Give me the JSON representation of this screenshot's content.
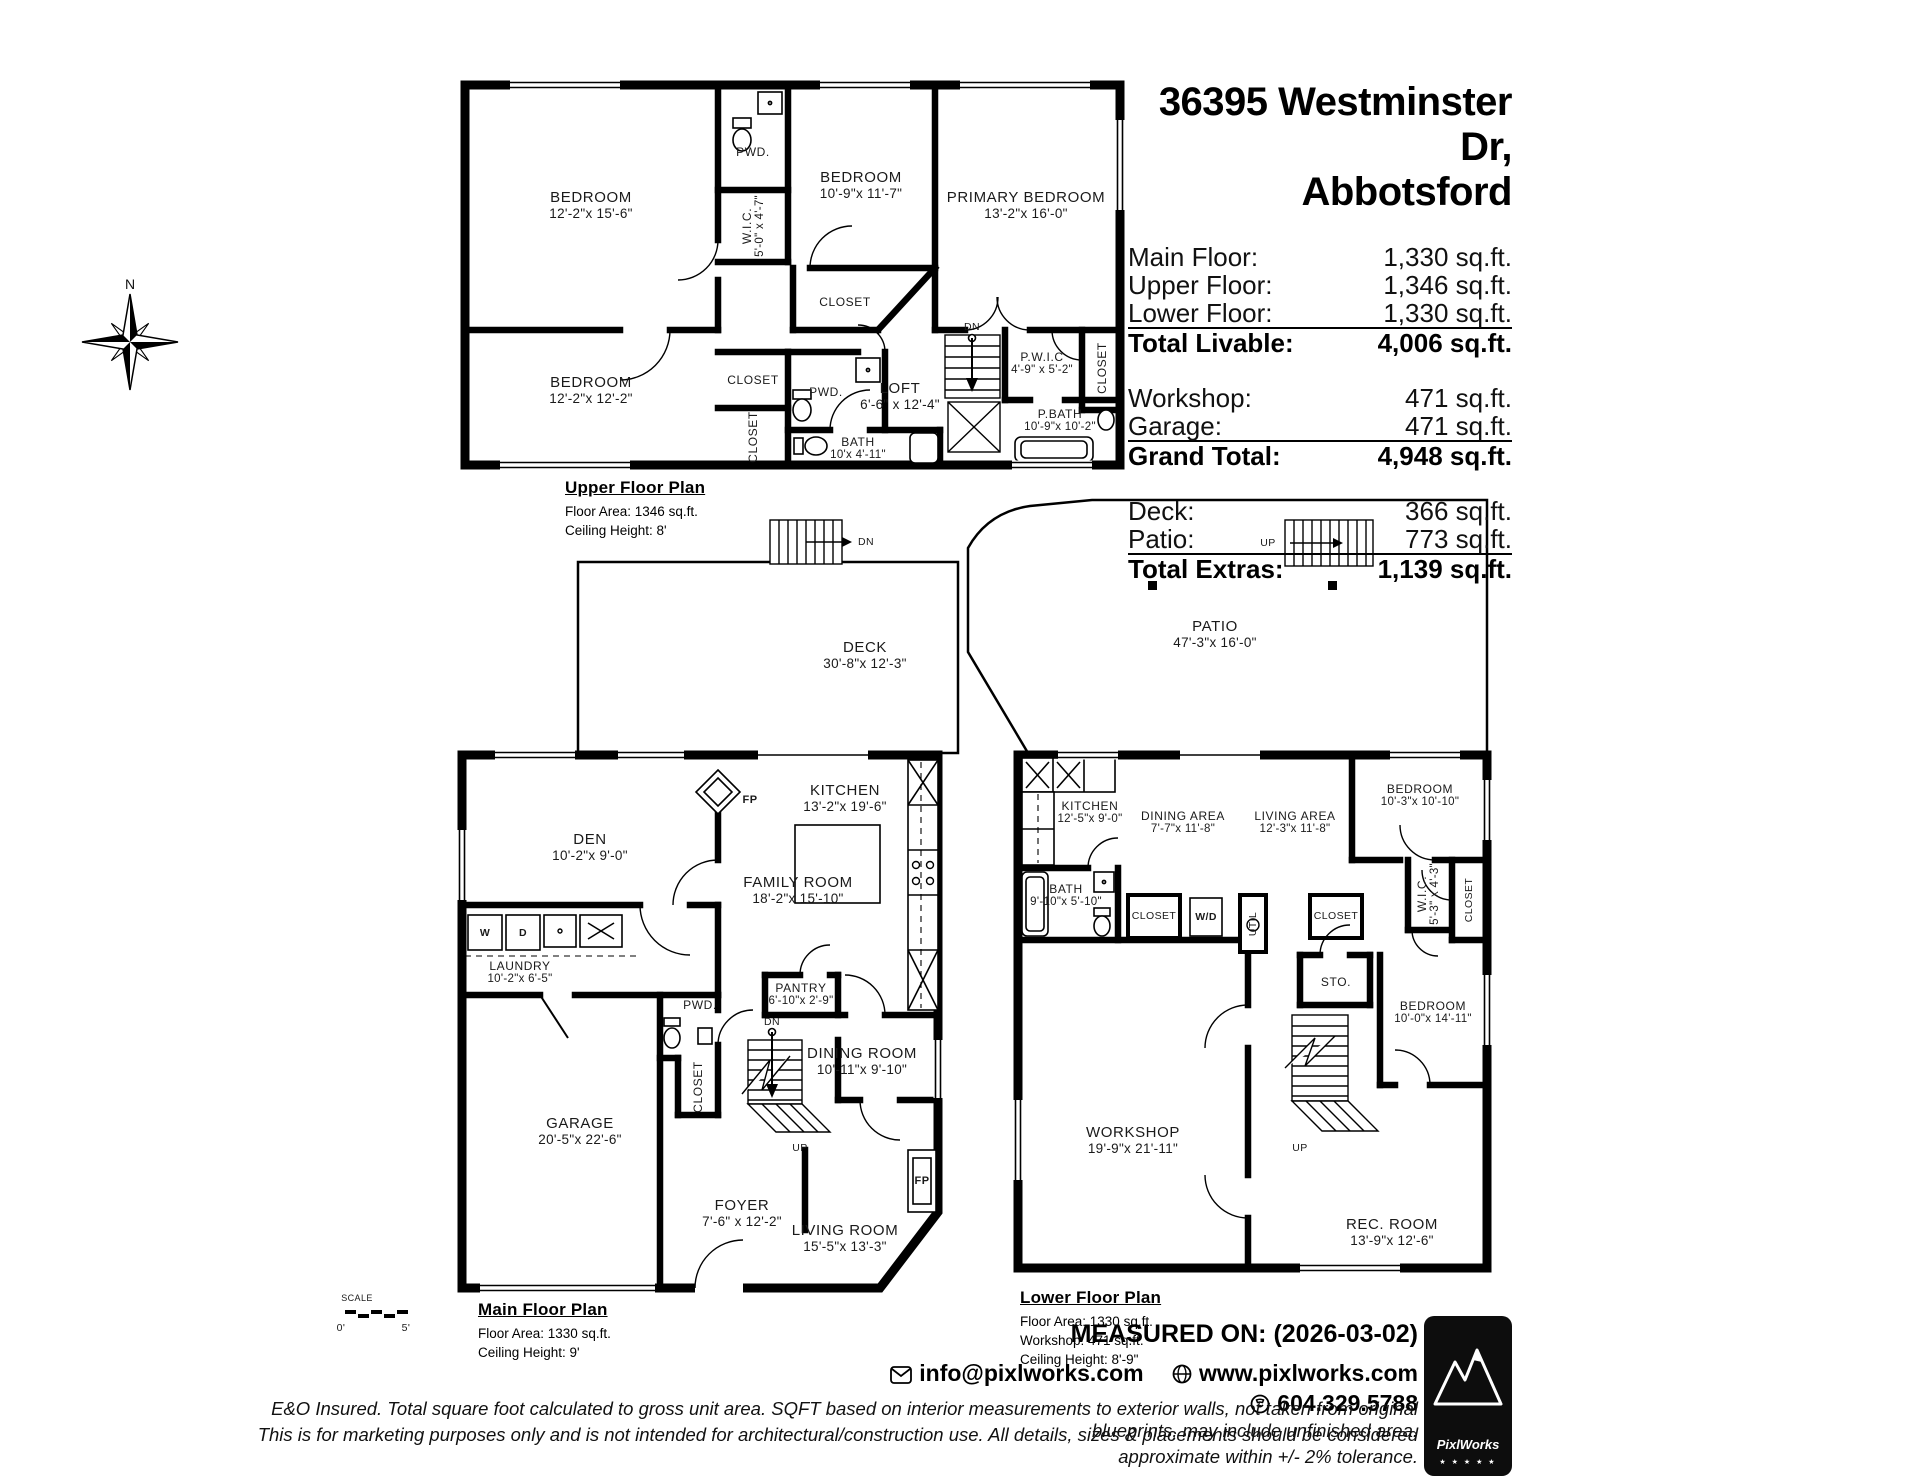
{
  "header": {
    "title1": "36395 Westminster Dr,",
    "title2": "Abbotsford",
    "livable": {
      "rows": [
        {
          "label": "Main Floor:",
          "value": "1,330 sq.ft."
        },
        {
          "label": "Upper Floor:",
          "value": "1,346 sq.ft."
        },
        {
          "label": "Lower Floor:",
          "value": "1,330 sq.ft."
        }
      ],
      "total_label": "Total Livable:",
      "total_value": "4,006 sq.ft."
    },
    "garage_group": {
      "rows": [
        {
          "label": "Workshop:",
          "value": "471 sq.ft."
        },
        {
          "label": "Garage:",
          "value": "471 sq.ft."
        }
      ],
      "total_label": "Grand Total:",
      "total_value": "4,948 sq.ft."
    },
    "extras": {
      "rows": [
        {
          "label": "Deck:",
          "value": "366 sq.ft."
        },
        {
          "label": "Patio:",
          "value": "773 sq.ft."
        }
      ],
      "total_label": "Total Extras:",
      "total_value": "1,139 sq.ft."
    }
  },
  "compass": {
    "north": "N"
  },
  "scale_bar": {
    "label": "SCALE",
    "start": "0'",
    "end": "5'"
  },
  "upper": {
    "caption": {
      "title": "Upper Floor Plan",
      "line1": "Floor Area: 1346 sq.ft.",
      "line2": "Ceiling Height: 8'"
    },
    "rooms": {
      "bedroom1": {
        "name": "BEDROOM",
        "dims": "12'-2\"x 15'-6\""
      },
      "pwd1": {
        "name": "PWD."
      },
      "wic": {
        "name": "W.I.C.",
        "dims": "5'-0\" x 4'-7\""
      },
      "bedroom2": {
        "name": "BEDROOM",
        "dims": "10'-9\"x 11'-7\""
      },
      "closet_b2": {
        "name": "CLOSET"
      },
      "primary": {
        "name": "PRIMARY BEDROOM",
        "dims": "13'-2\"x 16'-0\""
      },
      "bedroom3": {
        "name": "BEDROOM",
        "dims": "12'-2\"x 12'-2\""
      },
      "closet_a": {
        "name": "CLOSET"
      },
      "closet_b": {
        "name": "CLOSET"
      },
      "pwd2": {
        "name": "PWD."
      },
      "loft": {
        "name": "LOFT",
        "dims": "6'-6\" x 12'-4\""
      },
      "dn": {
        "name": "DN"
      },
      "pwic": {
        "name": "P.W.I.C",
        "dims": "4'-9\" x 5'-2\""
      },
      "closet_r": {
        "name": "CLOSET"
      },
      "bath": {
        "name": "BATH",
        "dims": "10'x 4'-11\""
      },
      "pbath": {
        "name": "P.BATH",
        "dims": "10'-9\"x 10'-2\""
      }
    }
  },
  "main": {
    "caption": {
      "title": "Main Floor Plan",
      "line1": "Floor Area: 1330 sq.ft.",
      "line2": "Ceiling Height: 9'"
    },
    "rooms": {
      "deck": {
        "name": "DECK",
        "dims": "30'-8\"x 12'-3\""
      },
      "deck_dn": {
        "name": "DN"
      },
      "fp1": {
        "name": "FP"
      },
      "den": {
        "name": "DEN",
        "dims": "10'-2\"x 9'-0\""
      },
      "family": {
        "name": "FAMILY ROOM",
        "dims": "18'-2\"x 15'-10\""
      },
      "kitchen": {
        "name": "KITCHEN",
        "dims": "13'-2\"x 19'-6\""
      },
      "laundry": {
        "name": "LAUNDRY",
        "dims": "10'-2\"x 6'-5\""
      },
      "w": {
        "name": "W"
      },
      "d": {
        "name": "D"
      },
      "pwd": {
        "name": "PWD."
      },
      "closet": {
        "name": "CLOSET"
      },
      "pantry": {
        "name": "PANTRY",
        "dims": "6'-10\"x 2'-9\""
      },
      "stairs_dn": {
        "name": "DN"
      },
      "stairs_up": {
        "name": "UP"
      },
      "dining": {
        "name": "DINING ROOM",
        "dims": "10'-11\"x 9'-10\""
      },
      "garage": {
        "name": "GARAGE",
        "dims": "20'-5\"x 22'-6\""
      },
      "foyer": {
        "name": "FOYER",
        "dims": "7'-6\" x 12'-2\""
      },
      "living": {
        "name": "LIVING ROOM",
        "dims": "15'-5\"x 13'-3\""
      },
      "fp2": {
        "name": "FP"
      }
    }
  },
  "lower": {
    "caption": {
      "title": "Lower Floor Plan",
      "line1": "Floor Area: 1330 sq.ft.",
      "line2": "Workshop: 471 sq.ft.",
      "line3": "Ceiling Height: 8'-9\""
    },
    "rooms": {
      "patio": {
        "name": "PATIO",
        "dims": "47'-3\"x 16'-0\""
      },
      "patio_up": {
        "name": "UP"
      },
      "kitchen": {
        "name": "KITCHEN",
        "dims": "12'-5\"x 9'-0\""
      },
      "dining": {
        "name": "DINING AREA",
        "dims": "7'-7\"x 11'-8\""
      },
      "living": {
        "name": "LIVING AREA",
        "dims": "12'-3\"x 11'-8\""
      },
      "bedroom1": {
        "name": "BEDROOM",
        "dims": "10'-3\"x 10'-10\""
      },
      "wic": {
        "name": "W.I.C.",
        "dims": "5'-3\" x 4'-3\""
      },
      "bath": {
        "name": "BATH",
        "dims": "9'-10\"x 5'-10\""
      },
      "closet1": {
        "name": "CLOSET"
      },
      "wd": {
        "name": "W/D"
      },
      "util": {
        "name": "UTIL"
      },
      "closet2": {
        "name": "CLOSET"
      },
      "closet3": {
        "name": "CLOSET"
      },
      "sto": {
        "name": "STO."
      },
      "bedroom2": {
        "name": "BEDROOM",
        "dims": "10'-0\"x 14'-11\""
      },
      "workshop": {
        "name": "WORKSHOP",
        "dims": "19'-9\"x 21'-11\""
      },
      "up": {
        "name": "UP"
      },
      "rec": {
        "name": "REC. ROOM",
        "dims": "13'-9\"x 12'-6\""
      }
    }
  },
  "footer": {
    "measured": "MEASURED ON: (2026-03-02)",
    "email": "info@pixlworks.com",
    "website": "www.pixlworks.com",
    "phone": "604.329.5788",
    "disclaimer1": "E&O Insured.  Total square foot calculated to gross unit area. SQFT based on interior measurements to exterior walls, not taken from original blueprints, may include unfinished area.",
    "disclaimer2": "This is for marketing purposes only and is not intended for architectural/construction use.  All details, sizes & placements should be considered approximate within +/- 2%  tolerance.",
    "brand": "PixlWorks",
    "stars": "★ ★ ★ ★ ★"
  }
}
